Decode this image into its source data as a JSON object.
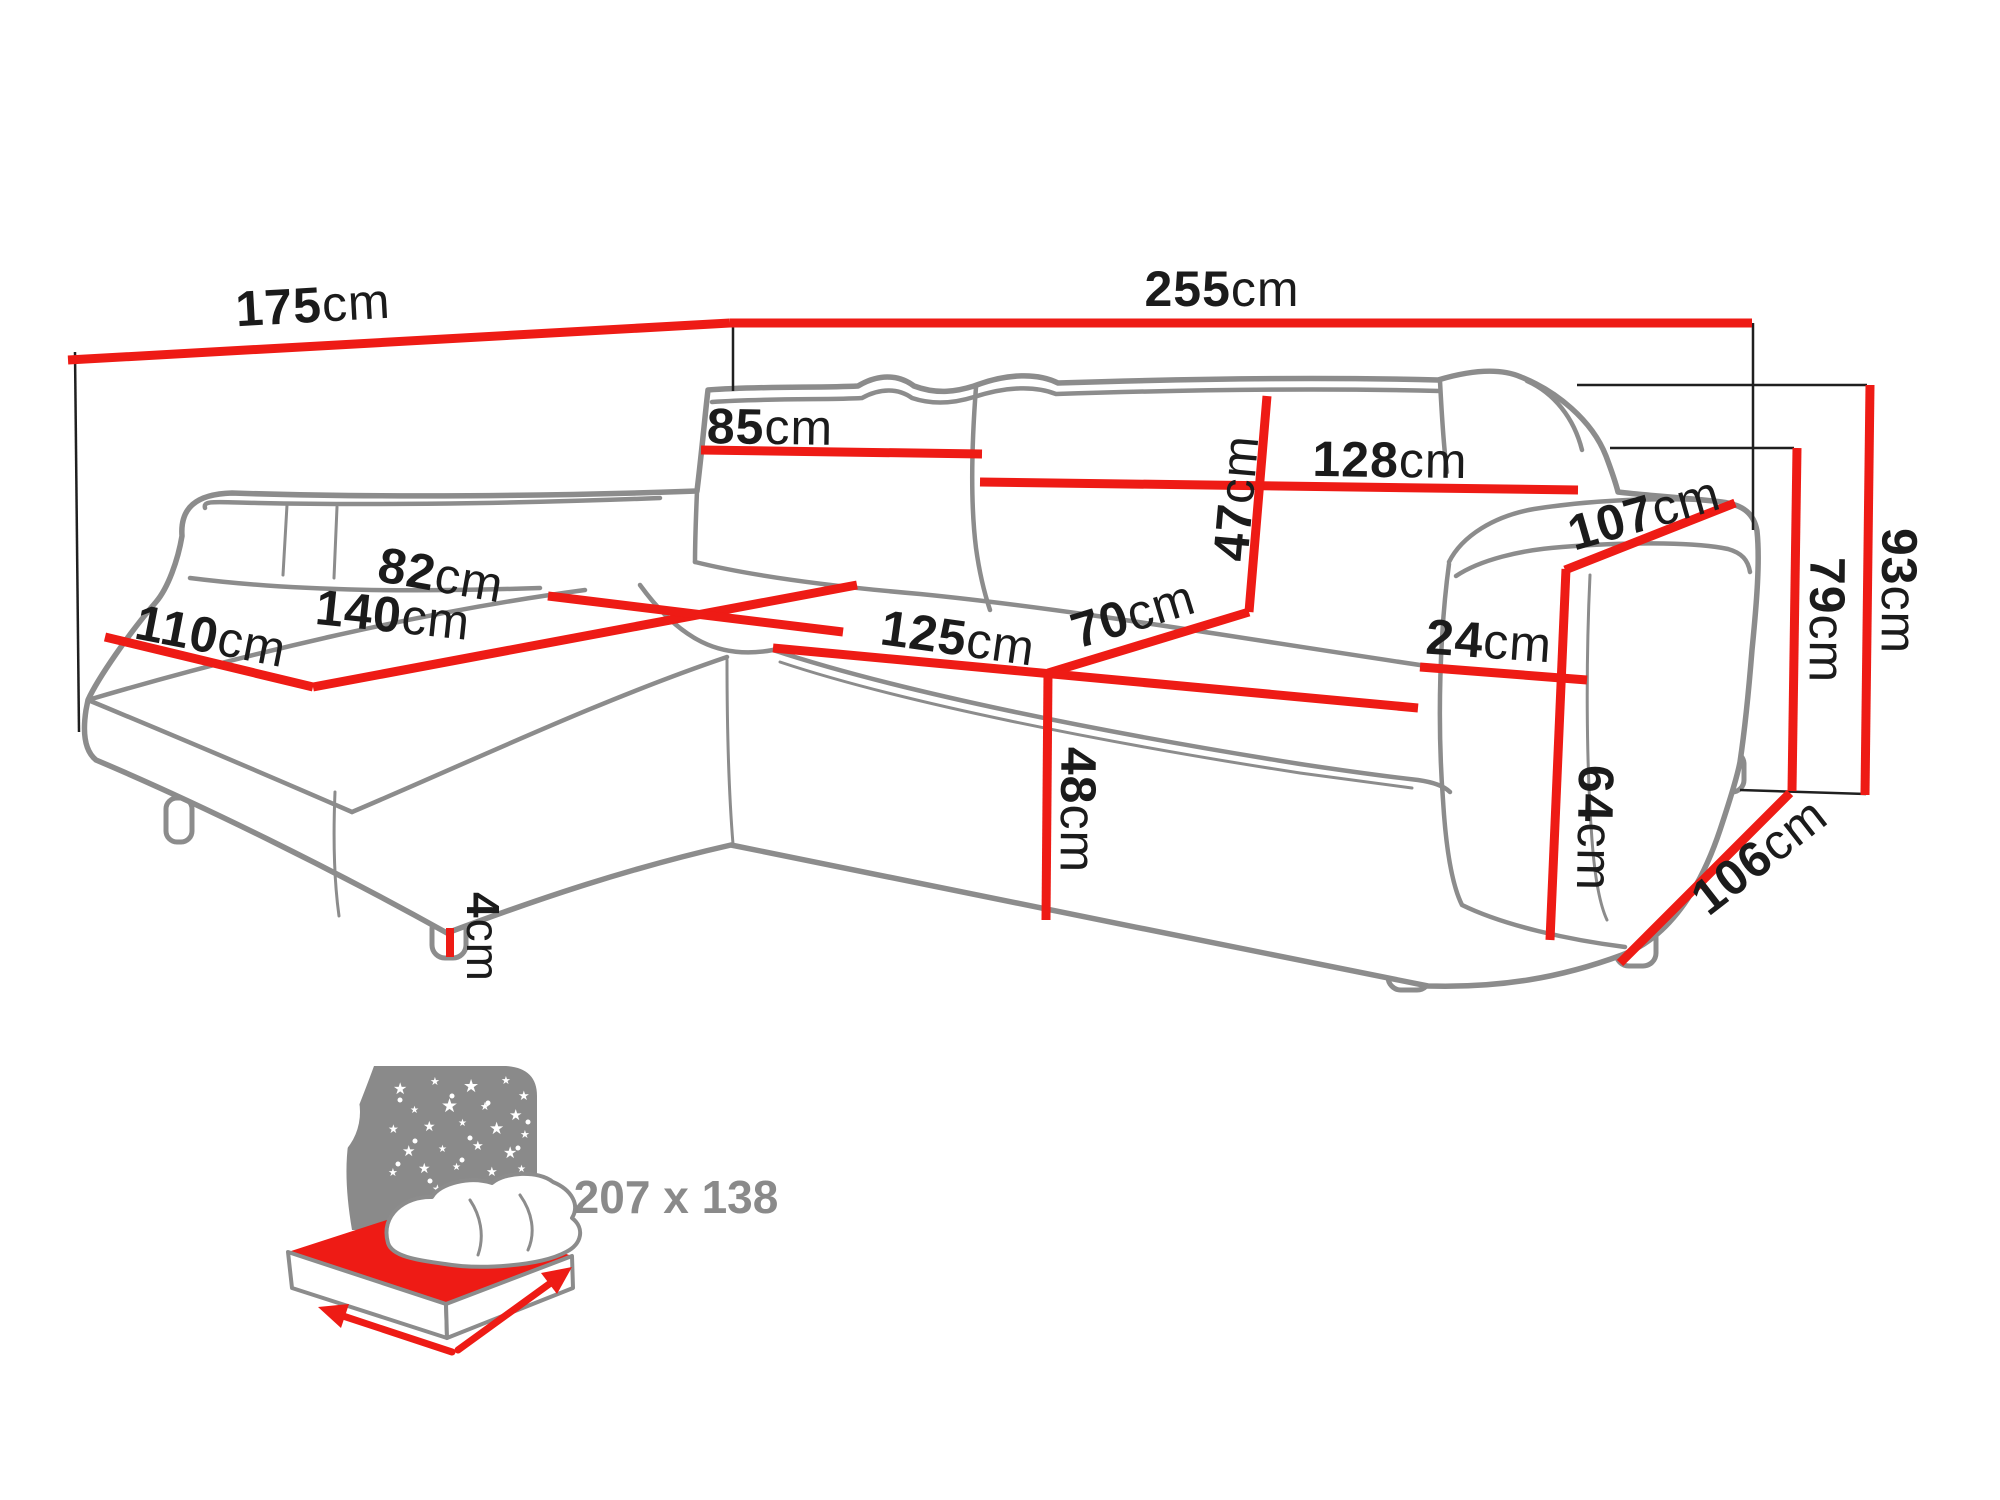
{
  "colors": {
    "dimension_red": "#ee1b15",
    "outline_gray": "#8c8c8c",
    "extension_black": "#1f1f1f",
    "label_black": "#1b1b1b",
    "icon_gray": "#8a8a8a"
  },
  "dims": {
    "d175": {
      "value": "175",
      "unit": "cm"
    },
    "d255": {
      "value": "255",
      "unit": "cm"
    },
    "d85": {
      "value": "85",
      "unit": "cm"
    },
    "d128": {
      "value": "128",
      "unit": "cm"
    },
    "d47": {
      "value": "47",
      "unit": "cm"
    },
    "d107": {
      "value": "107",
      "unit": "cm"
    },
    "d110": {
      "value": "110",
      "unit": "cm"
    },
    "d140": {
      "value": "140",
      "unit": "cm"
    },
    "d82": {
      "value": "82",
      "unit": "cm"
    },
    "d125": {
      "value": "125",
      "unit": "cm"
    },
    "d70": {
      "value": "70",
      "unit": "cm"
    },
    "d24": {
      "value": "24",
      "unit": "cm"
    },
    "d48": {
      "value": "48",
      "unit": "cm"
    },
    "d64": {
      "value": "64",
      "unit": "cm"
    },
    "d79": {
      "value": "79",
      "unit": "cm"
    },
    "d93": {
      "value": "93",
      "unit": "cm"
    },
    "d106": {
      "value": "106",
      "unit": "cm"
    },
    "d4": {
      "value": "4",
      "unit": "cm"
    }
  },
  "sleeping_area": {
    "label": "207 x 138"
  }
}
